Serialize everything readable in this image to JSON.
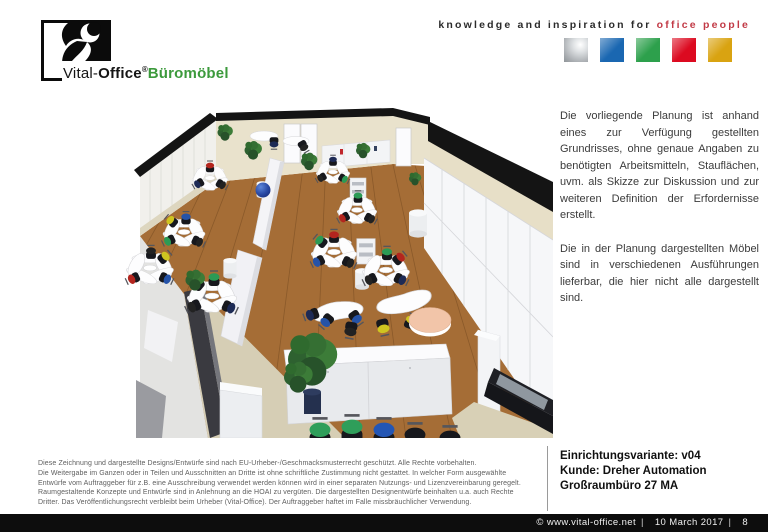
{
  "header": {
    "logo": {
      "brand_prefix": "Vital-",
      "brand_suffix": "Office",
      "registered": "®",
      "product": "Büromöbel"
    },
    "colors": {
      "brand_green": "#3c9a3c",
      "tagline_red": "#c23a46"
    },
    "tagline": {
      "black_part": "knowledge and inspiration for",
      "red_part": "office people"
    },
    "palette_squares": [
      {
        "name": "silver",
        "color": "#b4b8bb"
      },
      {
        "name": "blue",
        "color": "#1a67b1"
      },
      {
        "name": "green",
        "color": "#2da04c"
      },
      {
        "name": "red",
        "color": "#dc0a20"
      },
      {
        "name": "gold",
        "color": "#d9a311"
      }
    ]
  },
  "description": {
    "paragraph1": "Die vorliegende Planung ist anhand eines zur Verfügung gestellten Grundrisses, ohne genaue Angaben zu benötigten Arbeitsmitteln, Stauflächen, uvm. als Skizze zur Diskussion und zur weiteren Definition der Erfordernisse erstellt.",
    "paragraph2": "Die in der Planung dargestellten Möbel sind in verschiedenen Ausführungen lieferbar, die hier nicht alle dargestellt sind."
  },
  "legal": {
    "lines": [
      "Diese Zeichnung und dargestellte Designs/Entwürfe sind nach EU-Urheber-/Geschmacksmusterrecht geschützt. Alle Rechte vorbehalten.",
      "Die Weitergabe im Ganzen oder in Teilen und Ausschnitten an Dritte ist ohne schriftliche Zustimmung nicht gestattet. In welcher Form ausgewählte",
      "Entwürfe vom Auftraggeber für z.B. eine Ausschreibung verwendet werden können wird in einer separaten Nutzungs- und Lizenzvereinbarung geregelt.",
      "Raumgestaltende Konzepte und Entwürfe sind in Anlehnung an die HOAI zu vergüten. Die dargestellten Designentwürfe beinhalten u.a. auch Rechte",
      "Dritter. Das Veröffentlichungsrecht verbleibt beim Urheber (Vital-Office). Der Auftraggeber haftet im Falle missbräuchlicher Verwendung."
    ]
  },
  "project": {
    "variant": "Einrichtungsvariante: v04",
    "customer": "Kunde: Dreher Automation",
    "room": "Großraumbüro 27 MA"
  },
  "footer": {
    "copyright": "© www.vital-office.net",
    "separator": "|",
    "date": "10 March 2017",
    "page": "8"
  }
}
